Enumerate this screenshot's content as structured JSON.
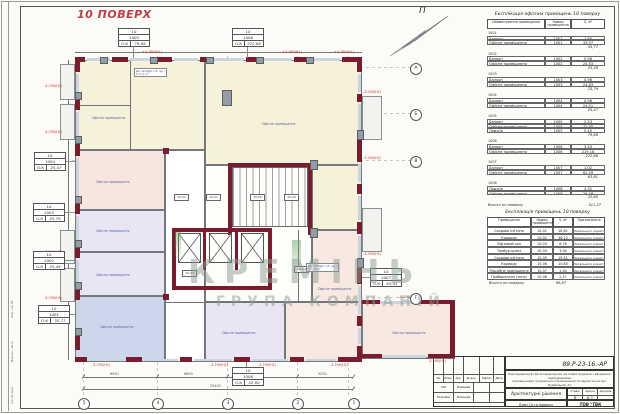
{
  "page": {
    "title": "10 ПОВЕРХ",
    "north": "П"
  },
  "watermark": {
    "l1": "КРЕМІНЬ",
    "l2": "ГРУПА КОМПАНІЙ"
  },
  "plan": {
    "office_text": "Офісне приміщення",
    "mark": "-3.290(Н1)",
    "mark2": "+3.190(Н1)",
    "core_rooms": [
      "10-02",
      "10-01",
      "10-05",
      "10-06",
      "10-03",
      "10-04"
    ],
    "notes": [
      {
        "l1": "Дв. №24ДК (зб. др.)",
        "l2": "S=1,4 м²"
      },
      {
        "l1": "Дв. №24ДК (зб. др.)",
        "l2": "S=1,4 м²"
      }
    ],
    "grid_bottom": [
      "5",
      "4",
      "3",
      "2",
      "1"
    ],
    "grid_right": [
      "А",
      "Б",
      "В",
      "Г"
    ],
    "dims": {
      "segments": [
        "6950",
        "6600",
        "6600",
        "5250"
      ],
      "total": "25400"
    }
  },
  "room_labels": [
    {
      "f": "10",
      "n": "1005",
      "t": "О-К",
      "a": "79,88"
    },
    {
      "f": "10",
      "n": "1006",
      "t": "О-К",
      "a": "222,66"
    },
    {
      "f": "10",
      "n": "1004",
      "t": "О-К",
      "a": "25,47"
    },
    {
      "f": "10",
      "n": "1003",
      "t": "О-К",
      "a": "25,79"
    },
    {
      "f": "10",
      "n": "1002",
      "t": "О-К",
      "a": "25,49"
    },
    {
      "f": "10",
      "n": "1001",
      "t": "О-К",
      "a": "35,77"
    },
    {
      "f": "10",
      "n": "1007",
      "t": "О-К",
      "a": "63,61"
    },
    {
      "f": "10",
      "n": "1008",
      "t": "О-К",
      "a": "32,60"
    }
  ],
  "office_table": {
    "title": "Експлікація офісних приміщень 10 поверху",
    "headers": [
      "Найменування приміщення",
      "Номер приміщення",
      "S, м²"
    ],
    "rows": [
      {
        "cls": "g",
        "n": "1001",
        "num": "",
        "a": ""
      },
      {
        "cls": "i",
        "n": "Балкон",
        "num": "1001",
        "a": "1,80"
      },
      {
        "cls": "i",
        "n": "Офісне приміщення",
        "num": "1001",
        "a": "33,97"
      },
      {
        "cls": "s",
        "n": "",
        "num": "",
        "a": "35,77"
      },
      {
        "cls": "g",
        "n": "1002",
        "num": "",
        "a": ""
      },
      {
        "cls": "i",
        "n": "Балкон",
        "num": "1002",
        "a": "0,96"
      },
      {
        "cls": "i",
        "n": "Офісне приміщення",
        "num": "1002",
        "a": "24,53"
      },
      {
        "cls": "s",
        "n": "",
        "num": "",
        "a": "25,49"
      },
      {
        "cls": "g",
        "n": "1003",
        "num": "",
        "a": ""
      },
      {
        "cls": "i",
        "n": "Балкон",
        "num": "1003",
        "a": "0,96"
      },
      {
        "cls": "i",
        "n": "Офісне приміщення",
        "num": "1003",
        "a": "24,83"
      },
      {
        "cls": "s",
        "n": "",
        "num": "",
        "a": "25,79"
      },
      {
        "cls": "g",
        "n": "1004",
        "num": "",
        "a": ""
      },
      {
        "cls": "i",
        "n": "Балкон",
        "num": "1004",
        "a": "0,96"
      },
      {
        "cls": "i",
        "n": "Офісне приміщення",
        "num": "1004",
        "a": "24,51"
      },
      {
        "cls": "s",
        "n": "",
        "num": "",
        "a": "25,47"
      },
      {
        "cls": "g",
        "n": "1005",
        "num": "",
        "a": ""
      },
      {
        "cls": "i",
        "n": "Балкон",
        "num": "1005",
        "a": "2,53"
      },
      {
        "cls": "i",
        "n": "Офісне приміщення",
        "num": "1005",
        "a": "71,95"
      },
      {
        "cls": "i",
        "n": "Лоджія",
        "num": "1005",
        "a": "5,40"
      },
      {
        "cls": "s",
        "n": "",
        "num": "",
        "a": "79,88"
      },
      {
        "cls": "g",
        "n": "1006",
        "num": "",
        "a": ""
      },
      {
        "cls": "i",
        "n": "Балкон",
        "num": "1006",
        "a": "3,50"
      },
      {
        "cls": "i",
        "n": "Офісне приміщення",
        "num": "1006",
        "a": "219,16"
      },
      {
        "cls": "s",
        "n": "",
        "num": "",
        "a": "222,66"
      },
      {
        "cls": "g",
        "n": "1007",
        "num": "",
        "a": ""
      },
      {
        "cls": "i",
        "n": "Балкон",
        "num": "1007",
        "a": "1,02"
      },
      {
        "cls": "i",
        "n": "Офісне приміщення",
        "num": "1007",
        "a": "62,59"
      },
      {
        "cls": "s",
        "n": "",
        "num": "",
        "a": "63,61"
      },
      {
        "cls": "g",
        "n": "1008",
        "num": "",
        "a": ""
      },
      {
        "cls": "i",
        "n": "Лоджія",
        "num": "1008",
        "a": "3,32"
      },
      {
        "cls": "i",
        "n": "Офісне приміщення",
        "num": "1008",
        "a": "29,28"
      },
      {
        "cls": "s",
        "n": "",
        "num": "",
        "a": "32,60"
      },
      {
        "cls": "t",
        "n": "Всього по поверху",
        "num": "",
        "a": "511,27"
      }
    ]
  },
  "expl_table": {
    "title": "Експлікація приміщень 10 поверху",
    "headers": [
      "Приміщення",
      "Номер приміщення",
      "S, м²",
      "Призначення"
    ],
    "rows": [
      {
        "name": "Сходова клітина",
        "num": "10-01",
        "s": "18,81",
        "p": "Загального корист."
      },
      {
        "name": "Коридор",
        "num": "10-02",
        "s": "36,12",
        "p": "Загального корист."
      },
      {
        "name": "Ліфтовий хол",
        "num": "10-03",
        "s": "6,78",
        "p": "Загального корист."
      },
      {
        "name": "Тамбур-шлюз",
        "num": "10-04",
        "s": "3,94",
        "p": "Загального корист."
      },
      {
        "name": "Сходова клітина",
        "num": "10-05",
        "s": "19,51",
        "p": "Загального корист."
      },
      {
        "name": "Коридор",
        "num": "10-06",
        "s": "10,80",
        "p": "Загального корист."
      },
      {
        "name": "Підсобне приміщення",
        "num": "10-07",
        "s": "1,44",
        "p": "Загального корист."
      },
      {
        "name": "Прибиральна (зона)",
        "num": "10-08",
        "s": "2,47",
        "p": "Загального корист."
      }
    ],
    "total_label": "Всього по поверху",
    "total": "99,87"
  },
  "stamp": {
    "code": "89.Р-23-16.-АР",
    "desc1": "Нове будівництво багатоквартирних житлових будинків з вбудовано-прибудованими",
    "desc2": "приміщеннями громадського призначення та паркінгом на вул. Будівельній, 21",
    "desc3": "у м. Києві. Архітектурні рішення. Коригування.",
    "section": "Архітектурні рішення",
    "stage_label": "Стадія",
    "sheet_label": "Аркуш",
    "sheets_label": "Аркушів",
    "stage": "Р",
    "sheet": "8.1",
    "sheets": "",
    "name": "План 10-го поверху",
    "company": "ТОВ \"ТВК \"АЛЬЯНС\"",
    "cols": [
      "Зм.",
      "Кільк.",
      "Арк.",
      "№ док.",
      "Підпис",
      "Дата"
    ],
    "rows": [
      {
        "role": "ГАП",
        "name": "Романова"
      },
      {
        "role": "Розробив",
        "name": "Романова"
      }
    ]
  },
  "margin": [
    "Інв. № ориг.",
    "Підпис і дата",
    "Зам. інв. №"
  ]
}
